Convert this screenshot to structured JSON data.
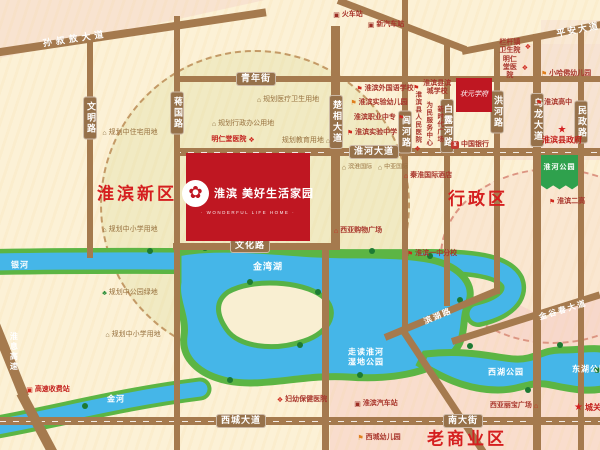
{
  "project": {
    "name": "淮滨 美好生活家园",
    "name_en": "· WONDERFUL LIFE HOME ·",
    "block_color": "#bf1722"
  },
  "blocks": {
    "zhuangyuan": "状元学府"
  },
  "districts": {
    "new_area": "淮滨新区",
    "admin_area": "行政区",
    "old_business": "老商业区"
  },
  "roads": {
    "sunshuao": "孙叔敖大道",
    "pingan": "平安大道",
    "qingnian": "青年街",
    "wenming": "文明路",
    "jiangguo": "蒋国路",
    "chuxiang": "楚相大道",
    "luhe": "闾河路",
    "bailuhe": "白露河路",
    "honghe": "洪河路",
    "wulong": "乌龙大道",
    "minzheng": "民政路",
    "huaihe_ave": "淮河大道",
    "wenhua": "文化路",
    "xicheng": "西城大道",
    "nandajie": "南大街",
    "binhu": "滨湖路",
    "jinguchun": "金谷春大道",
    "huaixi_expwy": "淮息高速"
  },
  "waters": {
    "yinhe": "银河",
    "jinhe": "金河",
    "jinwanhu": "金湾湖",
    "wetland": "走读淮河 湿地公园",
    "xihu": "西湖公园",
    "donghu": "东湖公园",
    "huaihe_park": "淮河公园"
  },
  "pois": {
    "train_station": "火车站",
    "bus_station_new": "新汽车站",
    "languan_clinic": "栏杆镇卫生院",
    "mingrentang_ne": "明仁堂医院",
    "harvard_kg": "小哈佛幼儿园",
    "huaibin_high": "淮滨高中",
    "county_gov": "淮滨县政府",
    "bank_china": "中国银行",
    "plan_medical": "规划医疗卫生用地",
    "plan_admin": "规划行政办公用地",
    "mingrentang_w": "明仁堂医院",
    "plan_edu": "规划教育用地",
    "plan_resid": "规划中住宅用地",
    "foreign_school": "淮滨外国语学校",
    "exp_kg": "淮滨实验幼儿园",
    "vocational": "淮滨职业中专",
    "exp_middle": "淮滨实验中学",
    "bincheng_school": "淮滨县滨城学校",
    "people_hospital": "淮滨县人民医院",
    "service_center": "为民服务中心",
    "new_era_plaza": "新时代广场",
    "binhuai_intl": "滨淮国际",
    "zhongya_intl": "中亚国际",
    "qinhuai_hotel": "秦淮国际酒店",
    "no2_high": "淮滨二高",
    "xiya_mall": "西亚购物广场",
    "yizhong_branch": "淮滨一中分校",
    "plan_primary1": "规划中小学用地",
    "plan_green": "规划中公园绿地",
    "plan_primary2": "规划中小学用地",
    "toll_gate": "高速收费站",
    "maternal_hospital": "妇幼保健医院",
    "bus_station": "淮滨汽车站",
    "xiya_libao": "西亚丽宝广场",
    "chengguan": "城关镇",
    "xicheng_kg": "西城幼儿园"
  },
  "icons": {
    "hospital": "❖",
    "school": "⚑",
    "kindergarten": "⚑",
    "planning": "⌂",
    "park_green": "♣",
    "government_star": "★",
    "bank": "¥",
    "train": "▣",
    "bus": "▣",
    "hotel": "⌂",
    "mall": "⌂",
    "toll": "▣",
    "flower": "✿"
  },
  "colors": {
    "road": "#a57a4e",
    "water": "#45b6e8",
    "bank_green": "#5cb544",
    "accent_red": "#d51f1f",
    "park_green": "#2fa14d"
  }
}
